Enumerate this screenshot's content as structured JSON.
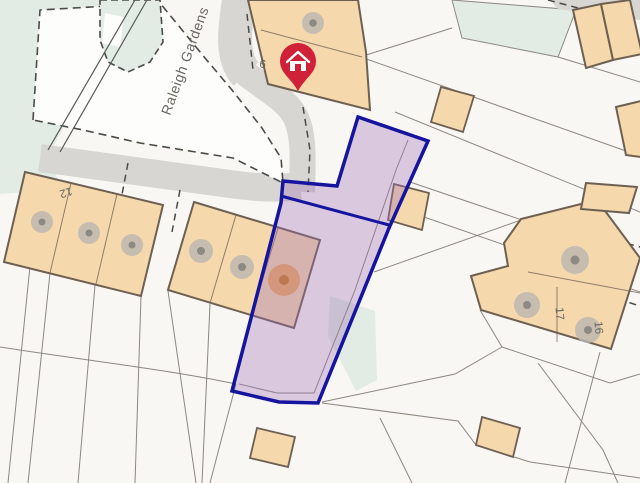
{
  "map": {
    "road_label": "Raleigh Gardens",
    "plot_labels": {
      "p9": "9",
      "p12": "12",
      "p17": "17",
      "p16": "16"
    },
    "marker": {
      "kind": "property-location-pin",
      "glyph": "house"
    },
    "highlight": {
      "kind": "title-plan-boundary"
    },
    "colors": {
      "bg": "#f9f7f3",
      "green": "#e2ebe4",
      "road": "#d8d6d2",
      "island": "#fdfdfb",
      "parcel-line": "#8b8880",
      "dash-line": "#4b4b46",
      "building": "#f5d8ac",
      "building-stroke": "#6d6052",
      "tree-outer": "#bab7b1",
      "tree-inner": "#8d8a84",
      "orange-tree-outer": "#f1a651",
      "orange-tree-inner": "#cd7d20",
      "highlight-fill": "#9a6bb5",
      "boundary": "#14149e",
      "pin": "#cf2137",
      "label": "#6a6760"
    }
  }
}
